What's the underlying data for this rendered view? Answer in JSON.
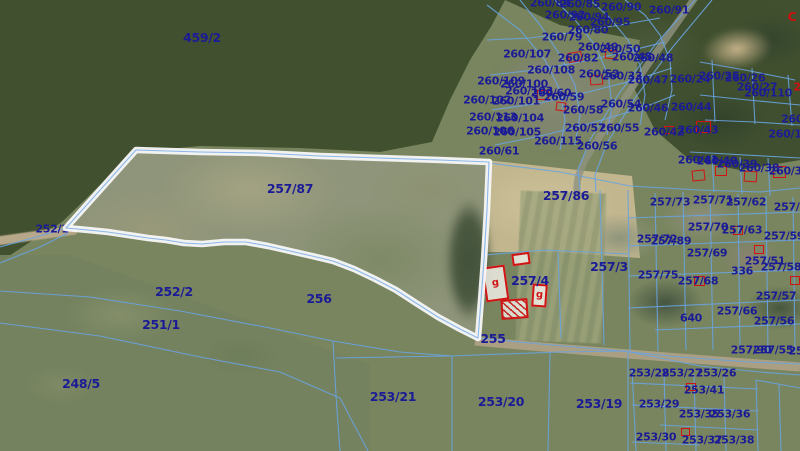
{
  "map": {
    "highlighted_parcel": "257/87",
    "colors": {
      "parcel_line": "#69a3e0",
      "label": "#1b1b96",
      "building": "#d01414",
      "highlight": "#f8f8f8"
    },
    "labels": [
      {
        "t": "459/2",
        "x": 202,
        "y": 38,
        "big": true
      },
      {
        "t": "260/84",
        "x": 550,
        "y": 3
      },
      {
        "t": "260/85",
        "x": 580,
        "y": 4
      },
      {
        "t": "260/90",
        "x": 621,
        "y": 7
      },
      {
        "t": "260/91",
        "x": 669,
        "y": 10
      },
      {
        "t": "260/92",
        "x": 565,
        "y": 15
      },
      {
        "t": "260/94",
        "x": 589,
        "y": 17
      },
      {
        "t": "260/95",
        "x": 610,
        "y": 22
      },
      {
        "t": "260/80",
        "x": 588,
        "y": 30
      },
      {
        "t": "260/79",
        "x": 562,
        "y": 37
      },
      {
        "t": "260/49",
        "x": 598,
        "y": 47
      },
      {
        "t": "260/50",
        "x": 620,
        "y": 49
      },
      {
        "t": "260/107",
        "x": 527,
        "y": 54
      },
      {
        "t": "260/82",
        "x": 578,
        "y": 58
      },
      {
        "t": "260/45",
        "x": 632,
        "y": 57
      },
      {
        "t": "260/48",
        "x": 653,
        "y": 58
      },
      {
        "t": "260/108",
        "x": 551,
        "y": 70
      },
      {
        "t": "260/52",
        "x": 599,
        "y": 74
      },
      {
        "t": "260/33",
        "x": 622,
        "y": 76
      },
      {
        "t": "260/47",
        "x": 648,
        "y": 80
      },
      {
        "t": "260/24",
        "x": 690,
        "y": 79
      },
      {
        "t": "260/25",
        "x": 719,
        "y": 76
      },
      {
        "t": "260/26",
        "x": 745,
        "y": 78
      },
      {
        "t": "260/27",
        "x": 757,
        "y": 87
      },
      {
        "t": "260/110",
        "x": 768,
        "y": 93
      },
      {
        "t": "260/109",
        "x": 501,
        "y": 81
      },
      {
        "t": "260/100",
        "x": 524,
        "y": 84
      },
      {
        "t": "260/103",
        "x": 529,
        "y": 91
      },
      {
        "t": "260/60",
        "x": 551,
        "y": 93
      },
      {
        "t": "260/102",
        "x": 487,
        "y": 100
      },
      {
        "t": "260/101",
        "x": 516,
        "y": 101
      },
      {
        "t": "260/113",
        "x": 493,
        "y": 117
      },
      {
        "t": "260/104",
        "x": 520,
        "y": 118
      },
      {
        "t": "260/106",
        "x": 490,
        "y": 131
      },
      {
        "t": "260/105",
        "x": 517,
        "y": 132
      },
      {
        "t": "260/59",
        "x": 564,
        "y": 97
      },
      {
        "t": "260/58",
        "x": 583,
        "y": 110
      },
      {
        "t": "260/54",
        "x": 621,
        "y": 104
      },
      {
        "t": "260/46",
        "x": 648,
        "y": 108
      },
      {
        "t": "260/44",
        "x": 691,
        "y": 107
      },
      {
        "t": "260/57",
        "x": 585,
        "y": 128
      },
      {
        "t": "260/55",
        "x": 619,
        "y": 128
      },
      {
        "t": "260/42",
        "x": 664,
        "y": 132
      },
      {
        "t": "260/43",
        "x": 698,
        "y": 130
      },
      {
        "t": "260/115",
        "x": 558,
        "y": 141
      },
      {
        "t": "260/56",
        "x": 597,
        "y": 146
      },
      {
        "t": "260/61",
        "x": 499,
        "y": 151
      },
      {
        "t": "260/41",
        "x": 698,
        "y": 160
      },
      {
        "t": "260/40",
        "x": 717,
        "y": 161
      },
      {
        "t": "260/39",
        "x": 737,
        "y": 164
      },
      {
        "t": "260/38",
        "x": 759,
        "y": 168
      },
      {
        "t": "260/36",
        "x": 789,
        "y": 171
      },
      {
        "t": "260/",
        "x": 794,
        "y": 119
      },
      {
        "t": "260/1",
        "x": 785,
        "y": 134
      },
      {
        "t": "257/87",
        "x": 290,
        "y": 189,
        "big": true
      },
      {
        "t": "257/86",
        "x": 566,
        "y": 196,
        "big": true
      },
      {
        "t": "257/73",
        "x": 670,
        "y": 202
      },
      {
        "t": "257/71",
        "x": 713,
        "y": 200
      },
      {
        "t": "257/62",
        "x": 746,
        "y": 202
      },
      {
        "t": "257/61",
        "x": 794,
        "y": 207
      },
      {
        "t": "257/70",
        "x": 708,
        "y": 227
      },
      {
        "t": "257/63",
        "x": 742,
        "y": 230
      },
      {
        "t": "257/59",
        "x": 784,
        "y": 236
      },
      {
        "t": "257/72",
        "x": 657,
        "y": 239
      },
      {
        "t": "257/89",
        "x": 671,
        "y": 241
      },
      {
        "t": "257/69",
        "x": 707,
        "y": 253
      },
      {
        "t": "257/51",
        "x": 765,
        "y": 261
      },
      {
        "t": "257/58",
        "x": 781,
        "y": 267
      },
      {
        "t": "336",
        "x": 742,
        "y": 271
      },
      {
        "t": "257/75",
        "x": 658,
        "y": 275
      },
      {
        "t": "257/3",
        "x": 609,
        "y": 267,
        "big": true
      },
      {
        "t": "257/4",
        "x": 530,
        "y": 281,
        "big": true
      },
      {
        "t": "257/68",
        "x": 698,
        "y": 281
      },
      {
        "t": "257/57",
        "x": 776,
        "y": 296
      },
      {
        "t": "640",
        "x": 691,
        "y": 318
      },
      {
        "t": "257/66",
        "x": 737,
        "y": 311
      },
      {
        "t": "257/56",
        "x": 774,
        "y": 321
      },
      {
        "t": "255",
        "x": 493,
        "y": 339,
        "big": true
      },
      {
        "t": "252/1",
        "x": 52,
        "y": 229
      },
      {
        "t": "252/2",
        "x": 174,
        "y": 292,
        "big": true
      },
      {
        "t": "251/1",
        "x": 161,
        "y": 325,
        "big": true
      },
      {
        "t": "256",
        "x": 319,
        "y": 299,
        "big": true
      },
      {
        "t": "248/5",
        "x": 81,
        "y": 384,
        "big": true
      },
      {
        "t": "253/21",
        "x": 393,
        "y": 397,
        "big": true
      },
      {
        "t": "253/20",
        "x": 501,
        "y": 402,
        "big": true
      },
      {
        "t": "253/19",
        "x": 599,
        "y": 404,
        "big": true
      },
      {
        "t": "257/90",
        "x": 751,
        "y": 350
      },
      {
        "t": "257/55",
        "x": 773,
        "y": 350
      },
      {
        "t": "25",
        "x": 796,
        "y": 351
      },
      {
        "t": "253/28",
        "x": 649,
        "y": 373
      },
      {
        "t": "253/27",
        "x": 682,
        "y": 373
      },
      {
        "t": "253/26",
        "x": 716,
        "y": 373
      },
      {
        "t": "253/41",
        "x": 704,
        "y": 390
      },
      {
        "t": "253/29",
        "x": 659,
        "y": 404
      },
      {
        "t": "253/35",
        "x": 699,
        "y": 414
      },
      {
        "t": "253/36",
        "x": 730,
        "y": 414
      },
      {
        "t": "253/30",
        "x": 656,
        "y": 437
      },
      {
        "t": "253/37",
        "x": 702,
        "y": 440
      },
      {
        "t": "253/38",
        "x": 734,
        "y": 440
      },
      {
        "t": "C",
        "x": 792,
        "y": 17,
        "c": "red",
        "big": true
      },
      {
        "t": "2",
        "x": 797,
        "y": 87,
        "c": "red"
      }
    ],
    "buildings": [
      {
        "x": 568,
        "y": 52,
        "w": 14,
        "h": 10,
        "r": -10
      },
      {
        "x": 605,
        "y": 50,
        "w": 12,
        "h": 9,
        "r": 5
      },
      {
        "x": 590,
        "y": 75,
        "w": 13,
        "h": 10,
        "r": -5
      },
      {
        "x": 537,
        "y": 90,
        "w": 12,
        "h": 10,
        "r": 0
      },
      {
        "x": 556,
        "y": 102,
        "w": 10,
        "h": 9,
        "r": 8
      },
      {
        "x": 696,
        "y": 121,
        "w": 15,
        "h": 12,
        "r": 0
      },
      {
        "x": 664,
        "y": 126,
        "w": 10,
        "h": 8,
        "r": 0
      },
      {
        "x": 692,
        "y": 170,
        "w": 13,
        "h": 11,
        "r": -6
      },
      {
        "x": 715,
        "y": 166,
        "w": 12,
        "h": 10,
        "r": 0
      },
      {
        "x": 744,
        "y": 171,
        "w": 13,
        "h": 11,
        "r": 4
      },
      {
        "x": 773,
        "y": 166,
        "w": 13,
        "h": 12,
        "r": 0
      },
      {
        "x": 733,
        "y": 226,
        "w": 10,
        "h": 9,
        "r": 0
      },
      {
        "x": 754,
        "y": 245,
        "w": 10,
        "h": 9,
        "r": 0
      },
      {
        "x": 694,
        "y": 276,
        "w": 11,
        "h": 10,
        "r": 0
      },
      {
        "x": 790,
        "y": 276,
        "w": 10,
        "h": 9,
        "r": 0
      },
      {
        "x": 686,
        "y": 383,
        "w": 10,
        "h": 8,
        "r": 0
      },
      {
        "x": 681,
        "y": 428,
        "w": 9,
        "h": 8,
        "r": 0
      },
      {
        "x": 484,
        "y": 266,
        "w": 23,
        "h": 35,
        "r": -8,
        "big": true,
        "g": "g"
      },
      {
        "x": 532,
        "y": 284,
        "w": 15,
        "h": 23,
        "r": 4,
        "big": true,
        "g": "g"
      },
      {
        "x": 501,
        "y": 299,
        "w": 27,
        "h": 20,
        "r": -4,
        "big": true,
        "hatch": true
      },
      {
        "x": 512,
        "y": 253,
        "w": 18,
        "h": 12,
        "r": -8,
        "big": true
      }
    ]
  }
}
